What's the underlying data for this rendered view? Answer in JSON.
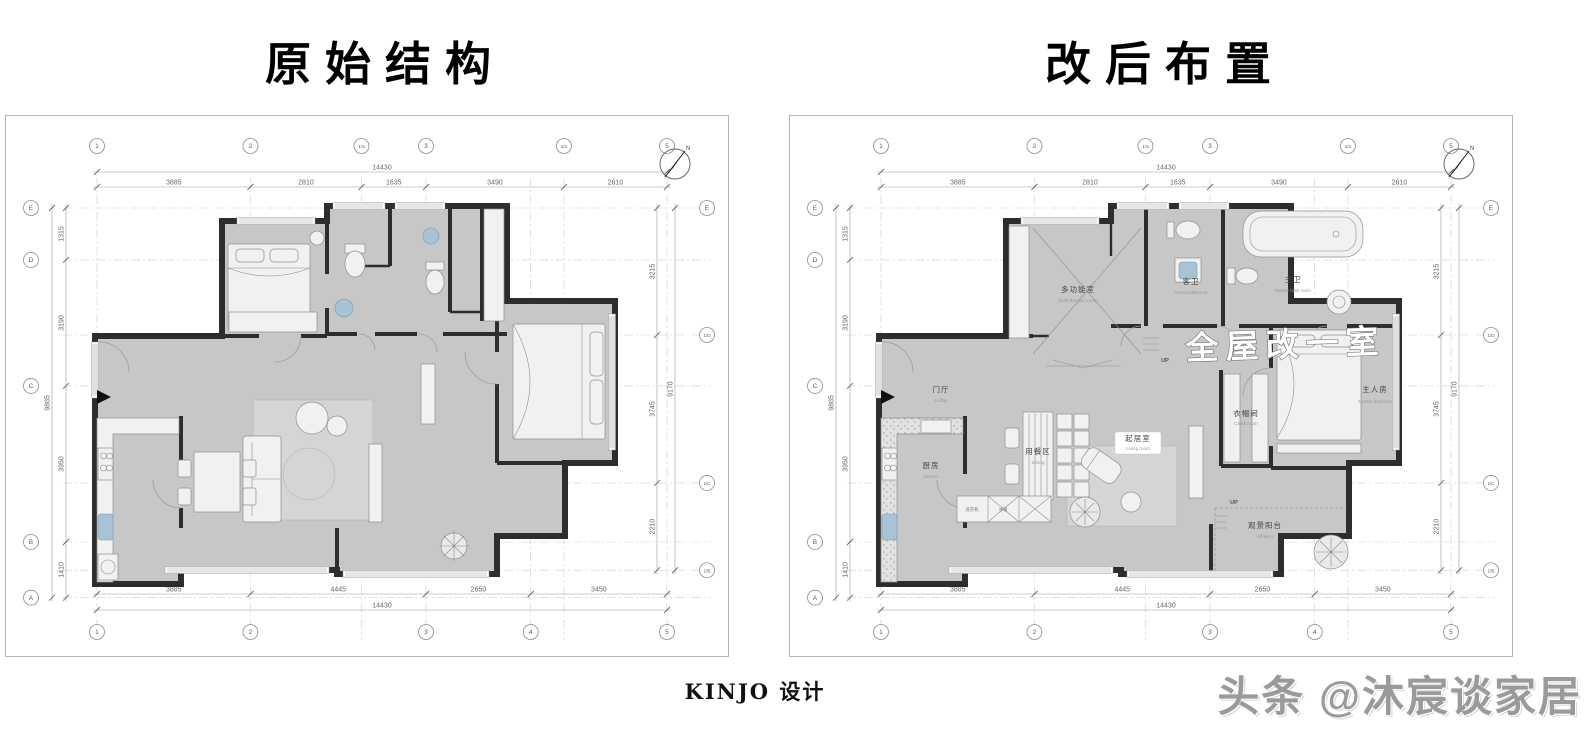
{
  "header": {
    "left_title": "原始结构",
    "right_title": "改后布置"
  },
  "footer": {
    "brand": "KINJO 设计",
    "watermark": "头条 @沐宸谈家居"
  },
  "compass": {
    "label": "N"
  },
  "axes": {
    "top": {
      "total": "14430",
      "segments": [
        "3885",
        "2810",
        "1635",
        "3490",
        "2610"
      ],
      "bubbles": [
        "1",
        "2",
        "1/3",
        "3",
        "1/4",
        "5"
      ]
    },
    "bottom": {
      "total": "14430",
      "segments": [
        "3885",
        "4445",
        "2650",
        "3450"
      ],
      "bubbles": [
        "1",
        "2",
        "3",
        "4",
        "5"
      ]
    },
    "left": {
      "total": "9865",
      "segments": [
        "1315",
        "3190",
        "3950",
        "1410"
      ],
      "bubbles": [
        "E",
        "D",
        "C",
        "B",
        "A"
      ]
    },
    "right": {
      "total": "9170",
      "segments": [
        "3215",
        "3745",
        "2210"
      ],
      "bubbles": [
        "E",
        "1/D",
        "1/C",
        "1/B"
      ]
    }
  },
  "plans": [
    {
      "name": "original-structure",
      "title": "原始结构"
    },
    {
      "name": "renovated-layout",
      "title": "改后布置",
      "watermark": "全屋改一室",
      "rooms": [
        {
          "zh": "多功能室",
          "en": "Multi-function room"
        },
        {
          "zh": "客卫",
          "en": "Guest bathroom"
        },
        {
          "zh": "主卫",
          "en": "Master bath room"
        },
        {
          "zh": "主人房",
          "en": "Master bedroom"
        },
        {
          "zh": "衣帽间",
          "en": "Cloak room"
        },
        {
          "zh": "门厅",
          "en": "Lobby"
        },
        {
          "zh": "厨房",
          "en": "Kitchen"
        },
        {
          "zh": "用餐区",
          "en": "Dining"
        },
        {
          "zh": "起居室",
          "en": "Living room"
        },
        {
          "zh": "观景阳台",
          "en": "Alfresco"
        }
      ],
      "annotations": {
        "up": "UP",
        "washer": "洗衣机",
        "fridge": "冰箱"
      }
    }
  ]
}
